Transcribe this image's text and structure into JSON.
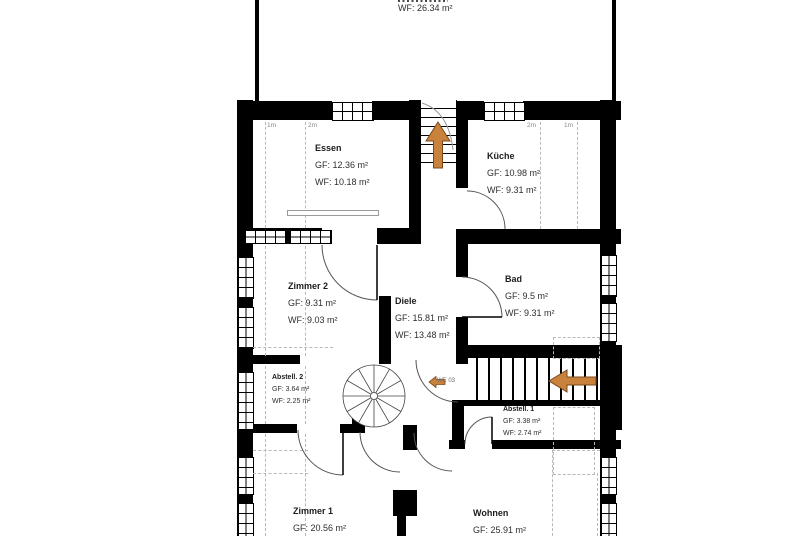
{
  "rooms": {
    "balkon": {
      "wf": "WF: 26.34 m²"
    },
    "essen": {
      "name": "Essen",
      "gf": "GF: 12.36 m²",
      "wf": "WF: 10.18 m²"
    },
    "kueche": {
      "name": "Küche",
      "gf": "GF: 10.98 m²",
      "wf": "WF: 9.31 m²"
    },
    "zimmer2": {
      "name": "Zimmer 2",
      "gf": "GF: 9.31 m²",
      "wf": "WF: 9.03 m²"
    },
    "diele": {
      "name": "Diele",
      "gf": "GF: 15.81 m²",
      "wf": "WF: 13.48 m²"
    },
    "bad": {
      "name": "Bad",
      "gf": "GF: 9.5 m²",
      "wf": "WF: 9.31 m²"
    },
    "abstell2": {
      "name": "Abstell. 2",
      "gf": "GF: 3.64 m²",
      "wf": "WF: 2.25 m²"
    },
    "abstell1": {
      "name": "Abstell. 1",
      "gf": "GF: 3.38 m²",
      "wf": "WF: 2.74 m²"
    },
    "zimmer1": {
      "name": "Zimmer 1",
      "gf": "GF: 20.56 m²"
    },
    "wohnen": {
      "name": "Wohnen",
      "gf": "GF: 25.91 m²"
    }
  },
  "labels": {
    "m1": "1m",
    "m2": "2m",
    "unit": "WE 03"
  },
  "colors": {
    "wall": "#000000",
    "arrow_fill": "#c8823c",
    "arrow_stroke": "#7a4a1d",
    "dash": "#b8b8b8",
    "text": "#2e2e2e"
  }
}
